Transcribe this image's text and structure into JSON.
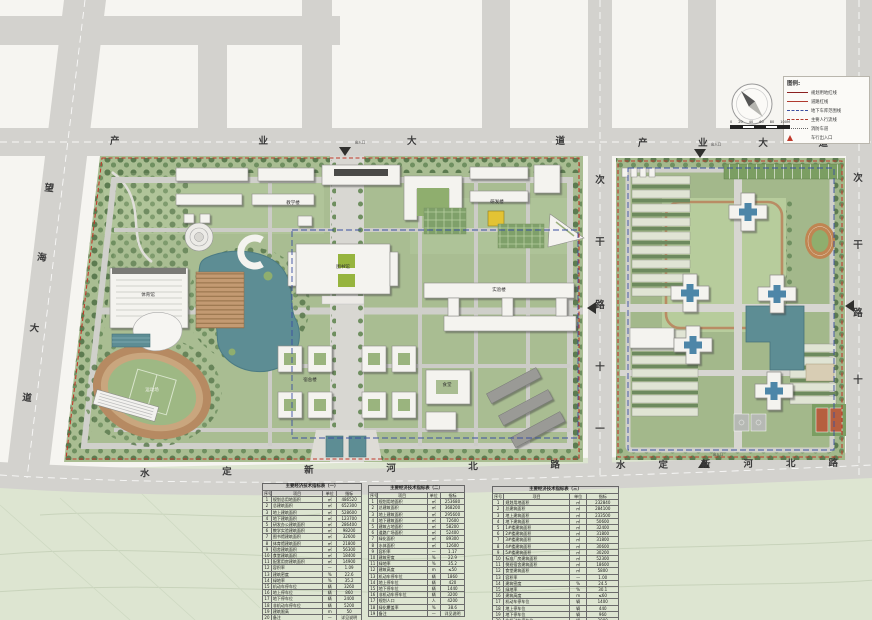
{
  "palette": {
    "road": "#d3d2ce",
    "water": "#5d8d94",
    "campus_green": "#a9bd92",
    "boundary_red": "#c0392b",
    "garage_blue": "#3a4fa0",
    "track_tan": "#c9a67e",
    "roof_blue": "#4e86a8"
  },
  "roads": {
    "top_left": "产业大道",
    "top_right": "产业大道",
    "left": "望海大道",
    "bottom_left": "水定新河北路",
    "bottom_right": "水定新河北路",
    "middle": "次干路十一",
    "right": "次干路十"
  },
  "entrance_label": "出入口",
  "legend": {
    "title": "图例:",
    "items": [
      {
        "symbol": "solid-dark",
        "label": "规划用地红线",
        "color": "#8b2020"
      },
      {
        "symbol": "solid",
        "label": "道路红线",
        "color": "#b03a2e"
      },
      {
        "symbol": "dash-blue",
        "label": "地下车库范围线",
        "color": "#3a4fa0"
      },
      {
        "symbol": "dash-red",
        "label": "主要人行流线",
        "color": "#b03a2e"
      },
      {
        "symbol": "dot",
        "label": "消防车道",
        "color": "#666666"
      },
      {
        "symbol": "tri",
        "label": "车行出入口",
        "color": "#c0392b"
      }
    ]
  },
  "scale_bar": {
    "labels": [
      "0",
      "20",
      "40",
      "60",
      "80",
      "100M"
    ]
  },
  "map_labels": [
    {
      "text": "教学楼"
    },
    {
      "text": "研发楼"
    },
    {
      "text": "图书馆"
    },
    {
      "text": "体育馆"
    },
    {
      "text": "运动场"
    },
    {
      "text": "实验楼"
    },
    {
      "text": "宿舍楼"
    },
    {
      "text": "食堂"
    }
  ],
  "tables": [
    {
      "title": "主要经济技术指标表（一）",
      "headers": [
        "序号",
        "项目",
        "单位",
        "指标"
      ],
      "rows": [
        {
          "n": "1",
          "item": "规划总用地面积",
          "unit": "㎡",
          "value": "486520"
        },
        {
          "n": "2",
          "item": "总建筑面积",
          "unit": "㎡",
          "value": "652300"
        },
        {
          "n": "3",
          "item": "地上建筑面积",
          "unit": "㎡",
          "value": "528600"
        },
        {
          "n": "4",
          "item": "地下建筑面积",
          "unit": "㎡",
          "value": "123700"
        },
        {
          "n": "5",
          "item": "研发办公建筑面积",
          "unit": "㎡",
          "value": "286400"
        },
        {
          "n": "6",
          "item": "教学实验建筑面积",
          "unit": "㎡",
          "value": "98200"
        },
        {
          "n": "7",
          "item": "图书馆建筑面积",
          "unit": "㎡",
          "value": "32600"
        },
        {
          "n": "8",
          "item": "体育馆建筑面积",
          "unit": "㎡",
          "value": "21800"
        },
        {
          "n": "9",
          "item": "宿舍建筑面积",
          "unit": "㎡",
          "value": "56300"
        },
        {
          "n": "10",
          "item": "食堂建筑面积",
          "unit": "㎡",
          "value": "18400"
        },
        {
          "n": "11",
          "item": "配套用房建筑面积",
          "unit": "㎡",
          "value": "14900"
        },
        {
          "n": "12",
          "item": "容积率",
          "unit": "—",
          "value": "1.09"
        },
        {
          "n": "13",
          "item": "建筑密度",
          "unit": "%",
          "value": "22.6"
        },
        {
          "n": "14",
          "item": "绿地率",
          "unit": "%",
          "value": "35.2"
        },
        {
          "n": "15",
          "item": "机动车停车位",
          "unit": "辆",
          "value": "3260"
        },
        {
          "n": "16",
          "item": "地上停车位",
          "unit": "辆",
          "value": "860"
        },
        {
          "n": "17",
          "item": "地下停车位",
          "unit": "辆",
          "value": "2400"
        },
        {
          "n": "18",
          "item": "非机动车停车位",
          "unit": "辆",
          "value": "5200"
        },
        {
          "n": "19",
          "item": "建筑限高",
          "unit": "m",
          "value": "50"
        },
        {
          "n": "20",
          "item": "备注",
          "unit": "—",
          "value": "详见说明"
        }
      ]
    },
    {
      "title": "主要经济技术指标表（二）",
      "headers": [
        "序号",
        "项目",
        "单位",
        "指标"
      ],
      "rows": [
        {
          "n": "1",
          "item": "规划用地面积",
          "unit": "㎡",
          "value": "253680"
        },
        {
          "n": "2",
          "item": "总建筑面积",
          "unit": "㎡",
          "value": "368200"
        },
        {
          "n": "3",
          "item": "地上建筑面积",
          "unit": "㎡",
          "value": "295600"
        },
        {
          "n": "4",
          "item": "地下建筑面积",
          "unit": "㎡",
          "value": "72600"
        },
        {
          "n": "5",
          "item": "建筑占地面积",
          "unit": "㎡",
          "value": "58200"
        },
        {
          "n": "6",
          "item": "道路广场面积",
          "unit": "㎡",
          "value": "52400"
        },
        {
          "n": "7",
          "item": "绿化面积",
          "unit": "㎡",
          "value": "89300"
        },
        {
          "n": "8",
          "item": "水体面积",
          "unit": "㎡",
          "value": "12600"
        },
        {
          "n": "9",
          "item": "容积率",
          "unit": "—",
          "value": "1.17"
        },
        {
          "n": "10",
          "item": "建筑密度",
          "unit": "%",
          "value": "22.9"
        },
        {
          "n": "11",
          "item": "绿地率",
          "unit": "%",
          "value": "35.2"
        },
        {
          "n": "12",
          "item": "建筑高度",
          "unit": "m",
          "value": "≤50"
        },
        {
          "n": "13",
          "item": "机动车停车位",
          "unit": "辆",
          "value": "1860"
        },
        {
          "n": "14",
          "item": "地上停车位",
          "unit": "辆",
          "value": "420"
        },
        {
          "n": "15",
          "item": "地下停车位",
          "unit": "辆",
          "value": "1440"
        },
        {
          "n": "16",
          "item": "非机动车停车位",
          "unit": "辆",
          "value": "3200"
        },
        {
          "n": "17",
          "item": "规划人口",
          "unit": "人",
          "value": "4200"
        },
        {
          "n": "18",
          "item": "绿化覆盖率",
          "unit": "%",
          "value": "38.6"
        },
        {
          "n": "19",
          "item": "备注",
          "unit": "—",
          "value": "详见说明"
        }
      ]
    },
    {
      "title": "主要经济技术指标表（三）",
      "headers": [
        "序号",
        "项目",
        "单位",
        "指标"
      ],
      "rows": [
        {
          "n": "1",
          "item": "规划用地面积",
          "unit": "㎡",
          "value": "232840"
        },
        {
          "n": "2",
          "item": "总建筑面积",
          "unit": "㎡",
          "value": "284100"
        },
        {
          "n": "3",
          "item": "地上建筑面积",
          "unit": "㎡",
          "value": "233500"
        },
        {
          "n": "4",
          "item": "地下建筑面积",
          "unit": "㎡",
          "value": "50600"
        },
        {
          "n": "5",
          "item": "1#楼建筑面积",
          "unit": "㎡",
          "value": "32400"
        },
        {
          "n": "6",
          "item": "2#楼建筑面积",
          "unit": "㎡",
          "value": "31800"
        },
        {
          "n": "7",
          "item": "3#楼建筑面积",
          "unit": "㎡",
          "value": "31800"
        },
        {
          "n": "8",
          "item": "4#楼建筑面积",
          "unit": "㎡",
          "value": "30600"
        },
        {
          "n": "9",
          "item": "5#楼建筑面积",
          "unit": "㎡",
          "value": "30200"
        },
        {
          "n": "10",
          "item": "标准厂房建筑面积",
          "unit": "㎡",
          "value": "52300"
        },
        {
          "n": "11",
          "item": "倒班宿舍建筑面积",
          "unit": "㎡",
          "value": "18600"
        },
        {
          "n": "12",
          "item": "食堂建筑面积",
          "unit": "㎡",
          "value": "5800"
        },
        {
          "n": "13",
          "item": "容积率",
          "unit": "—",
          "value": "1.00"
        },
        {
          "n": "14",
          "item": "建筑密度",
          "unit": "%",
          "value": "24.5"
        },
        {
          "n": "15",
          "item": "绿地率",
          "unit": "%",
          "value": "30.1"
        },
        {
          "n": "16",
          "item": "建筑高度",
          "unit": "m",
          "value": "≤60"
        },
        {
          "n": "17",
          "item": "机动车停车位",
          "unit": "辆",
          "value": "1400"
        },
        {
          "n": "18",
          "item": "地上停车位",
          "unit": "辆",
          "value": "440"
        },
        {
          "n": "19",
          "item": "地下停车位",
          "unit": "辆",
          "value": "960"
        },
        {
          "n": "20",
          "item": "非机动车停车位",
          "unit": "辆",
          "value": "2000"
        },
        {
          "n": "21",
          "item": "规划人口",
          "unit": "人",
          "value": "6800"
        },
        {
          "n": "22",
          "item": "备注",
          "unit": "—",
          "value": "详见说明"
        }
      ]
    }
  ]
}
